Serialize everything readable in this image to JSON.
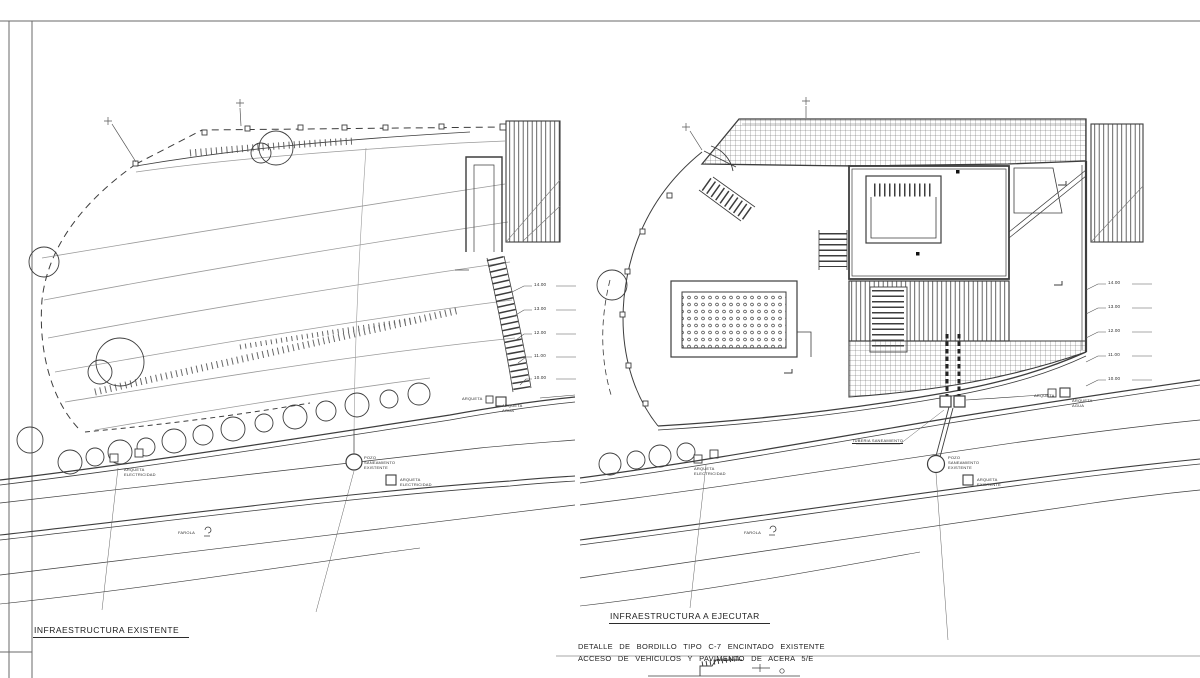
{
  "sheet": {
    "background": "#ffffff",
    "line_color": "#3d3d3d",
    "light_line_color": "#9a9a9a"
  },
  "left_plan": {
    "title": "INFRAESTRUCTURA EXISTENTE",
    "labels": {
      "pozo": "POZO\nSANEAMIENTO\nEXISTENTE",
      "arqueta_electricidad_trees": "ARQUETA\nELECTRICIDAD",
      "arqueta_electricidad_road": "ARQUETA\nELECTRICIDAD",
      "arqueta": "ARQUETA",
      "arqueta_agua": "ARQUETA\nAGUA",
      "farola": "FAROLA"
    },
    "elevations": [
      "14.00",
      "13.00",
      "12.00",
      "11.00",
      "10.00"
    ]
  },
  "right_plan": {
    "title": "INFRAESTRUCTURA A EJECUTAR",
    "labels": {
      "pozo": "POZO\nSANEAMIENTO\nEXISTENTE",
      "arqueta_electricidad": "ARQUETA\nELECTRICIDAD",
      "arqueta_existente": "ARQUETA\nEXISTENTE",
      "arqueta": "ARQUETA",
      "arqueta_agua": "ARQUETA\nAGUA",
      "tuberia": "TUBERIA SANEAMIENTO",
      "farola": "FAROLA"
    },
    "elevations": [
      "14.00",
      "13.00",
      "12.00",
      "11.00",
      "10.00"
    ]
  },
  "caption": {
    "line1": "DETALLE DE BORDILLO TIPO C-7 ENCINTADO EXISTENTE",
    "line2": "ACCESO DE VEHICULOS Y PAVIMENTO DE ACERA 5/E"
  }
}
